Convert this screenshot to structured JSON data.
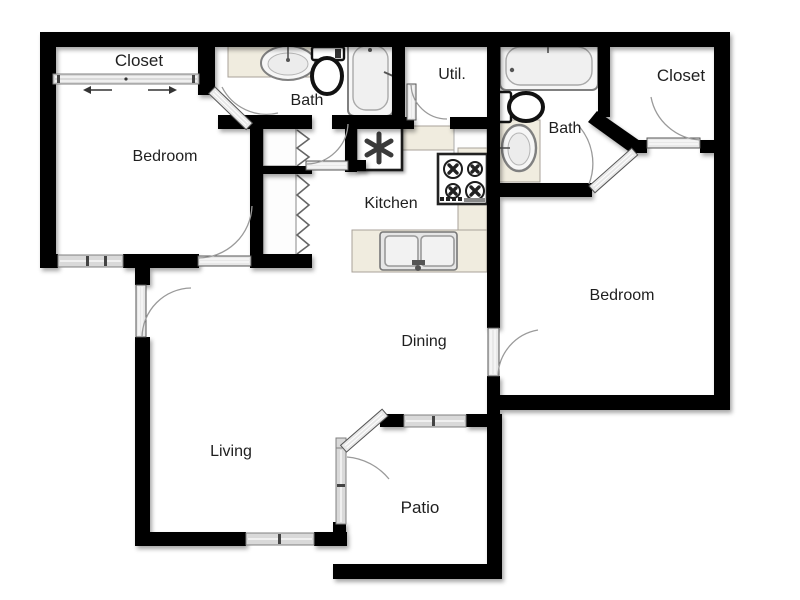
{
  "plan_title": "Two Bedroom Apartment Floor Plan",
  "rooms": {
    "closet_left": "Closet",
    "bedroom_left": "Bedroom",
    "bath_left": "Bath",
    "util": "Util.",
    "bath_right": "Bath",
    "closet_right": "Closet",
    "kitchen": "Kitchen",
    "bedroom_right": "Bedroom",
    "dining": "Dining",
    "living": "Living",
    "patio": "Patio"
  },
  "icons": {
    "water_heater": "asterisk-symbol",
    "bathtub_left": "vertical-bathtub",
    "bathtub_right": "horizontal-bathtub",
    "toilet_left": "toilet-top-view",
    "toilet_right": "toilet-side-facing-right",
    "sink_bath_left": "oval-vanity-sink",
    "sink_bath_right": "oval-vanity-sink",
    "stove": "four-burner-cooktop",
    "kitchen_sink": "double-basin-sink",
    "sliding_closet_door": "bypass-slider-with-arrows",
    "bifold_doors": "accordion-zigzag",
    "swing_doors": "quarter-arc-door-swing",
    "windows": "striped-wall-opening"
  },
  "colors": {
    "wall": "#000000",
    "window_fill": "#d9d9d9",
    "counter_fill": "#f0ecdf",
    "door_leaf_fill": "#e8e8e8",
    "arc_stroke": "#9a9a9a",
    "label_color": "#1f1f1f",
    "background": "#ffffff"
  }
}
